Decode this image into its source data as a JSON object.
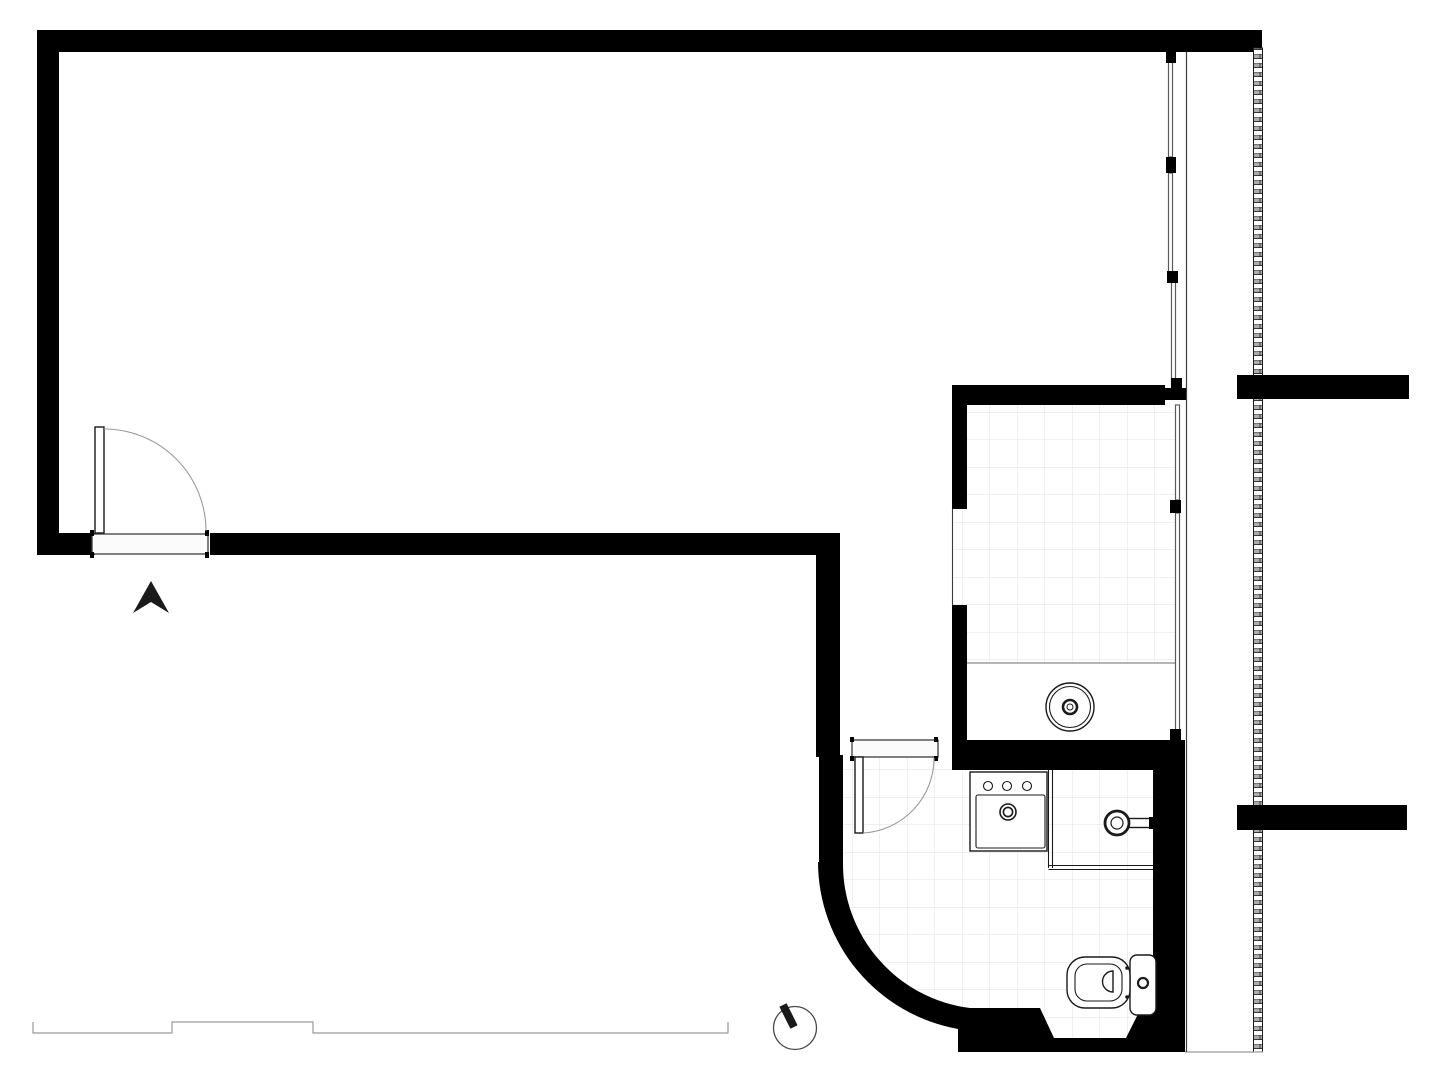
{
  "document": {
    "kind": "architectural-floor-plan",
    "visible_text": "",
    "scale_annotations": "none"
  },
  "colors": {
    "wall": "#000000",
    "paper": "#ffffff",
    "tile_line": "#e2e2e2",
    "glass": "#5a5a5a",
    "fixture": "#1a1a1a",
    "light_line": "#9a9a9a",
    "outline": "#3c3c3c",
    "hatch_fill": "#ababab"
  },
  "plan": {
    "rooms": [
      {
        "name": "main-room",
        "floor": "plain"
      },
      {
        "name": "hallway",
        "floor": "plain"
      },
      {
        "name": "kitchen",
        "floor": "tiled"
      },
      {
        "name": "bathroom",
        "floor": "tiled"
      }
    ],
    "fixtures": [
      {
        "name": "entry-door-with-swing"
      },
      {
        "name": "entrance-direction-arrow"
      },
      {
        "name": "glazed-sliding-wall"
      },
      {
        "name": "kitchen-counter"
      },
      {
        "name": "kitchen-round-sink"
      },
      {
        "name": "bathroom-door-with-swing"
      },
      {
        "name": "washbasin-three-tap-holes"
      },
      {
        "name": "shower-with-wall-mixer"
      },
      {
        "name": "toilet-with-cistern"
      },
      {
        "name": "curved-wall"
      },
      {
        "name": "round-column-marker"
      },
      {
        "name": "terrace-step-edge"
      },
      {
        "name": "hatched-existing-wall"
      },
      {
        "name": "party-wall-stub-upper"
      },
      {
        "name": "party-wall-stub-lower"
      }
    ]
  }
}
